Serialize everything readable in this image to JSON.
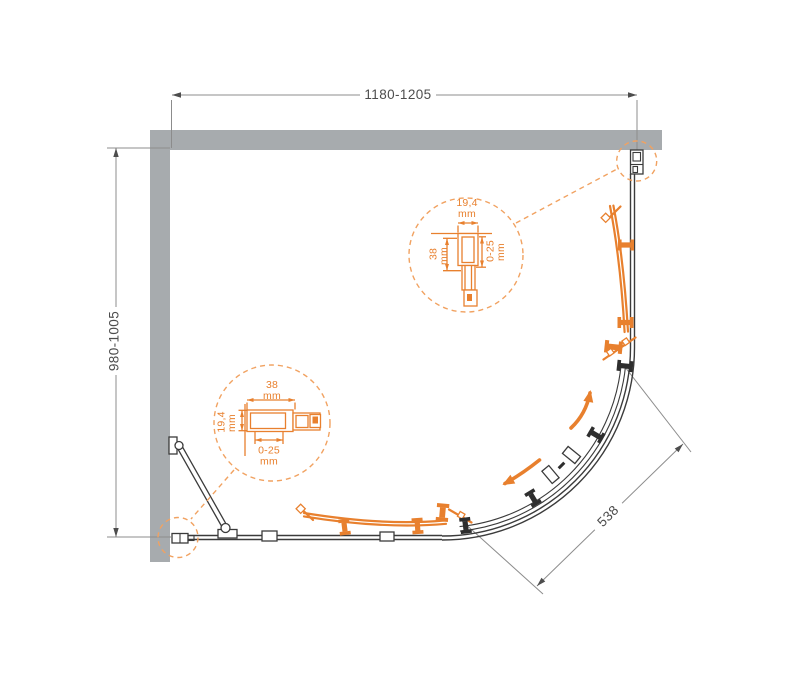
{
  "drawing": {
    "type": "quadrant-shower-enclosure-plan",
    "colors": {
      "accent_orange": "#E8802E",
      "accent_orange_light": "#F1A261",
      "wall_gray": "#A7ABAE",
      "line_dark": "#3B3B3B",
      "dimension_gray": "#8C8C8C",
      "text_gray": "#4D4D4D"
    }
  },
  "dimensions": {
    "width": {
      "label": "1180-1205"
    },
    "depth": {
      "label": "980-1005"
    },
    "entry": {
      "label": "538"
    }
  },
  "details": {
    "top_right": {
      "profile_width": "19,4",
      "profile_width_unit": "mm",
      "profile_depth": "38",
      "profile_depth_unit": "mm",
      "adjustment_range": "0-25",
      "adjustment_range_unit": "mm"
    },
    "bottom_left": {
      "profile_depth": "38",
      "profile_depth_unit": "mm",
      "profile_width": "19,4",
      "profile_width_unit": "mm",
      "adjustment_range": "0-25",
      "adjustment_range_unit": "mm"
    }
  }
}
